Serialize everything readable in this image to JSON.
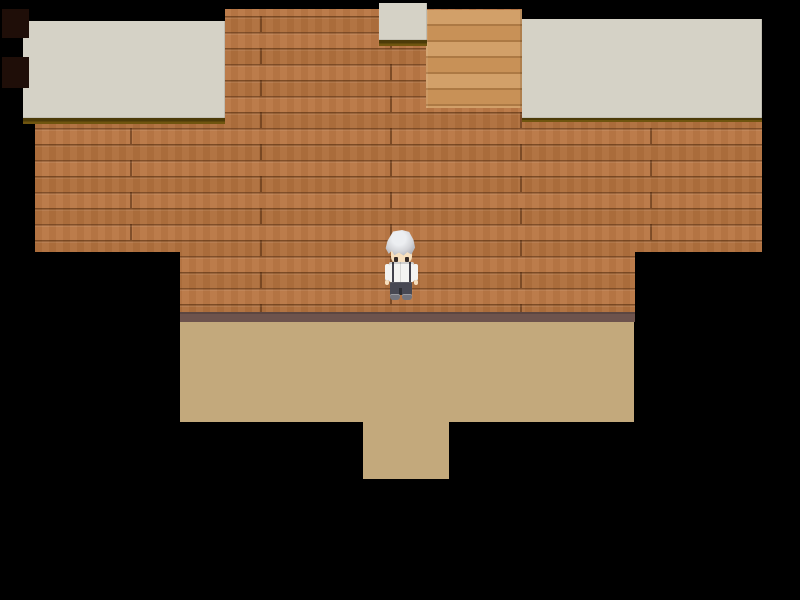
{
  "scene": {
    "type": "rpg-room-interior",
    "description": "Top-down pixel-art room: stepped brick wall with gray ceiling ledges, light wood panel, mauve baseboard, tan floor with doorway extension at bottom, surrounded by blackness",
    "visible_text": ""
  },
  "palette": {
    "background": "#000000",
    "brick_base": "#b06f3d",
    "brick_row_light": "#ba7845",
    "ceiling_gray": "#d5d2c6",
    "trim_dark": "#4c3b08",
    "trim_gold": "#6f550f",
    "plank_light": "#d2a069",
    "plank_mid": "#c89157",
    "plank_seam": "#ac7944",
    "baseboard_mauve": "#6d534d",
    "floor_tan": "#c3a97c",
    "alcove_dark": "#1f0e08"
  },
  "character": {
    "name": "silver-haired-villager",
    "facing": "down",
    "position": "center of room, standing against brick wall above baseboard",
    "colors": {
      "hair": "#d3d4d8",
      "hair_shadow": "#a2a3ab",
      "skin": "#f7dfbd",
      "eyes": "#352a26",
      "shirt": "#f3f3f1",
      "shirt_trim": "#41414b",
      "pants": "#474853",
      "shoes": "#72737c"
    }
  }
}
